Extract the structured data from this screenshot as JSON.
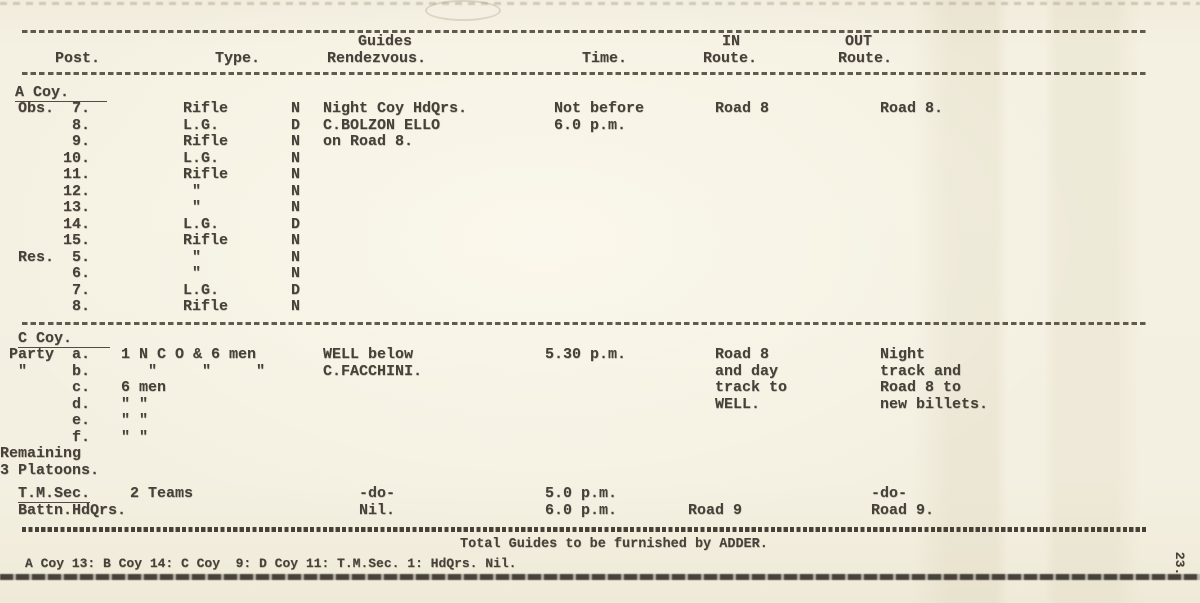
{
  "colors": {
    "paper": "#f4f0e1",
    "ink": "#48413a"
  },
  "page": {
    "page_number": "23."
  },
  "header": {
    "col_post": "Post.",
    "col_type": "Type.",
    "col_guides1": "Guides",
    "col_guides2": "Rendezvous.",
    "col_time": "Time.",
    "col_in1": "IN",
    "col_in2": "Route.",
    "col_out1": "OUT",
    "col_out2": "Route."
  },
  "sections": [
    {
      "id": "a-coy",
      "title": "A Coy.",
      "rows": [
        {
          "post": "  Obs.  7.",
          "type": "Rifle",
          "guide": "N",
          "rdv": "Night Coy HdQrs.",
          "time": " Not before",
          "in": "   Road 8",
          "out": " Road 8."
        },
        {
          "post": "        8.",
          "type": "L.G.",
          "guide": "D",
          "rdv": "C.BOLZON ELLO",
          "time": " 6.0 p.m."
        },
        {
          "post": "        9.",
          "type": "Rifle",
          "guide": "N",
          "rdv": "on Road 8."
        },
        {
          "post": "       10.",
          "type": "L.G.",
          "guide": "N"
        },
        {
          "post": "       11.",
          "type": "Rifle",
          "guide": "N"
        },
        {
          "post": "       12.",
          "type": " \"",
          "guide": "N"
        },
        {
          "post": "       13.",
          "type": " \"",
          "guide": "N"
        },
        {
          "post": "       14.",
          "type": "L.G.",
          "guide": "D"
        },
        {
          "post": "       15.",
          "type": "Rifle",
          "guide": "N"
        },
        {
          "post": "  Res.  5.",
          "type": " \"",
          "guide": "N"
        },
        {
          "post": "        6.",
          "type": " \"",
          "guide": "N"
        },
        {
          "post": "        7.",
          "type": "L.G.",
          "guide": "D"
        },
        {
          "post": "        8.",
          "type": "Rifle",
          "guide": "N"
        }
      ]
    },
    {
      "id": "c-coy",
      "title": "C Coy.",
      "rows": [
        {
          "post": " Party  a.",
          "type": "1 N C O & 6 men",
          "rdv": "WELL below",
          "time": "5.30 p.m.",
          "in": "   Road 8",
          "out": " Night"
        },
        {
          "post": "  \"     b.",
          "type": "   \"     \"     \"",
          "rdv": "C.FACCHINI.",
          "in": "   and day",
          "out": " track and"
        },
        {
          "post": "        c.",
          "type": "6 men",
          "in": "   track to",
          "out": " Road 8 to"
        },
        {
          "post": "        d.",
          "type": "\" \"",
          "in": "   WELL.",
          "out": " new billets."
        },
        {
          "post": "        e.",
          "type": "\" \""
        },
        {
          "post": "        f.",
          "type": "\" \""
        },
        {
          "post": "Remaining"
        },
        {
          "post": "3 Platoons."
        }
      ]
    },
    {
      "id": "tm",
      "title": "",
      "rows": [
        {
          "post_pre": "  ",
          "post": "T.M.Sec.",
          "post_u": true,
          "type": " 2 Teams",
          "rdv": "    -do-",
          "time": "5.0 p.m.",
          "out": "-do-"
        },
        {
          "post_pre": "  ",
          "post": "Battn.HdQrs.",
          "post_u": false,
          "rdv": "    Nil.",
          "time": "6.0 p.m.",
          "in": "Road 9",
          "out": "Road 9."
        }
      ]
    }
  ],
  "footer": {
    "total_line": "Total Guides to be furnished by ADDER.",
    "tally_line": "A Coy 13: B Coy 14: C Coy  9: D Coy 11: T.M.Sec. 1: HdQrs. Nil."
  }
}
